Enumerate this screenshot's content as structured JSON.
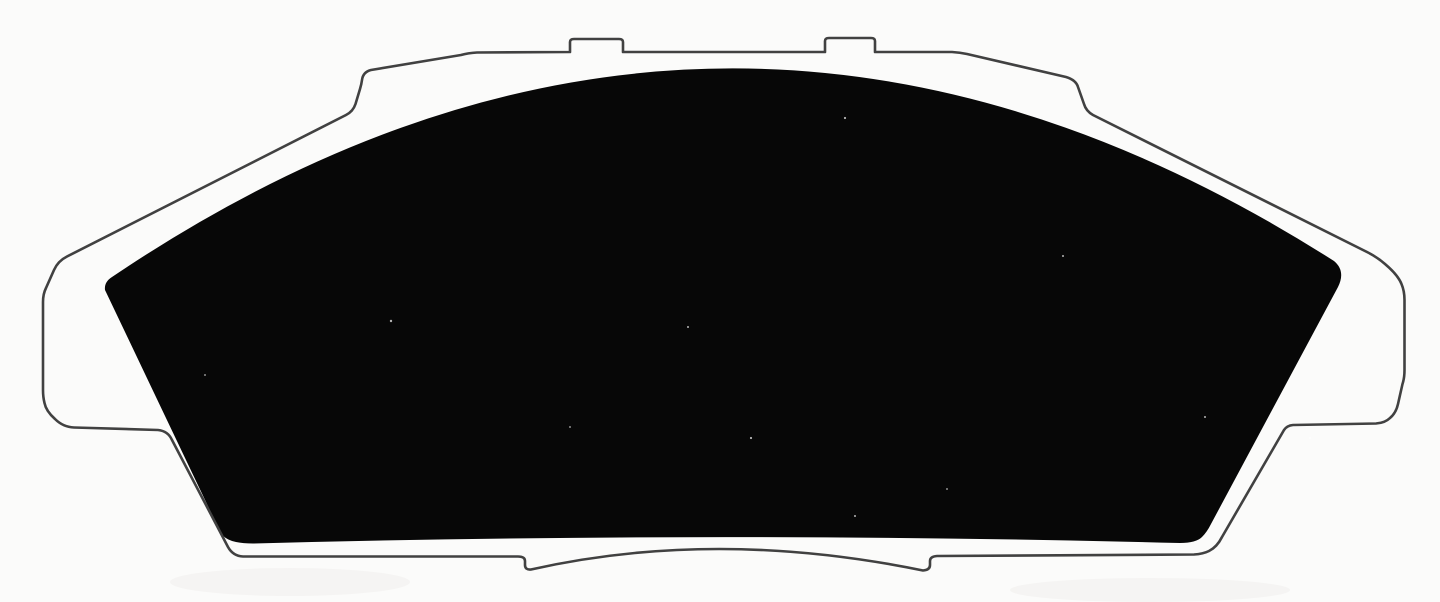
{
  "figure": {
    "subject": "disc-brake-pad",
    "description": "Scanned monochrome technical illustration of a disc brake pad viewed face-on: a thin gray outline of the steel backing plate with two small rectangular abutment tabs on the top edge, stepped shoulders on the upper diagonals, side ledges, and a notched lower edge with a shallow center hump; the solid black region is the friction material with an arched top edge, slanted sides and rounded corners."
  },
  "colors": {
    "background": "#fbfbfa",
    "plate_outline": "#414141",
    "friction_pad": "#070707",
    "scan_shade": "#f1efec"
  }
}
